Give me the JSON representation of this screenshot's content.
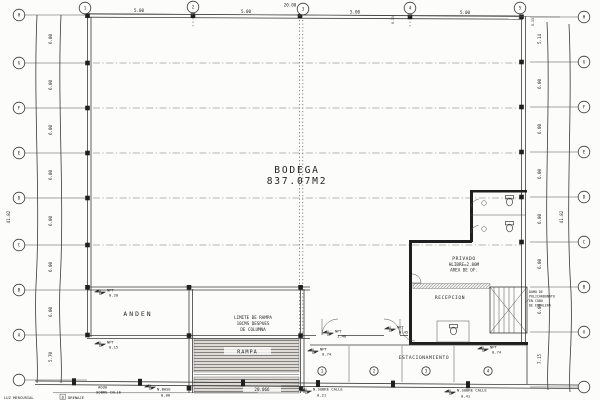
{
  "colors": {
    "ink": "#2f2f2f",
    "paper": "#fcfcfa"
  },
  "rooms": {
    "bodega_name": "BODEGA",
    "bodega_area": "837.07M2",
    "anden": "ANDEN",
    "rampa": "RAMPA",
    "recepcion": "RECEPCION",
    "estacionamiento": "ESTACIONAMIENTO",
    "privado_l1": "PRIVADO",
    "privado_l2": "HLIBRE=2.80M",
    "privado_l3": "AREA DE OF."
  },
  "top_grid": {
    "bubbles": [
      "1",
      "2",
      "3",
      "4",
      "5"
    ],
    "dims": [
      "5.00",
      "5.00",
      "5.00",
      "5.00"
    ],
    "total": "20.00",
    "edge_dims": [
      "0.15",
      "0.15"
    ]
  },
  "left_grid": {
    "bubbles": [
      "H",
      "G",
      "F",
      "E",
      "D",
      "C",
      "B",
      "A",
      ""
    ],
    "dims": [
      "6.00",
      "6.00",
      "6.00",
      "6.00",
      "6.00",
      "6.00",
      "6.00",
      "5.70"
    ],
    "total": "41.82"
  },
  "right_grid": {
    "bubbles": [
      "H",
      "G",
      "F",
      "E",
      "D",
      "C",
      "B",
      "A",
      ""
    ],
    "dims": [
      "5.14",
      "6.00",
      "6.00",
      "6.00",
      "6.00",
      "6.00",
      "6.00",
      "7.15"
    ],
    "total": "41.82"
  },
  "notes": {
    "limite_l1": "LIMITE DE RAMPA",
    "limite_l2": "10CMS DESPUES",
    "limite_l3": "DE COLUMNA",
    "domo_l1": "DOMO DE",
    "domo_l2": "POLICARBONATO",
    "domo_l3": "EN CUBO",
    "domo_l4": "DE ESCALERA",
    "rampa_length": "20.066"
  },
  "levels": {
    "anden_top": {
      "label": "NPT",
      "value": "0.20"
    },
    "anden_low": {
      "label": "NPT",
      "value": "0.15"
    },
    "vestibulo": {
      "label": "NPT",
      "value": "1.40"
    },
    "acceso": {
      "label": "NPT",
      "value": "0.45"
    },
    "parking_a": {
      "label": "NPT",
      "value": "0.74"
    },
    "parking_b": {
      "label": "NPT",
      "value": "0.74"
    }
  },
  "street": {
    "base": {
      "label": "N.BASE",
      "value": "0.00"
    },
    "calle_centro": {
      "label": "N.SOBRE CALLE",
      "value": "0.21"
    },
    "calle_der": {
      "label": "N.SOBRE CALLE",
      "value": "0.41"
    },
    "luz": "LUZ MERCURIAL",
    "agua_l1": "AGUA",
    "agua_l2": "SOBRE CALLE",
    "drenaje_tag": "D",
    "drenaje": "DRENAJE"
  },
  "parking": {
    "stalls": [
      "1",
      "2",
      "3",
      "4"
    ]
  }
}
